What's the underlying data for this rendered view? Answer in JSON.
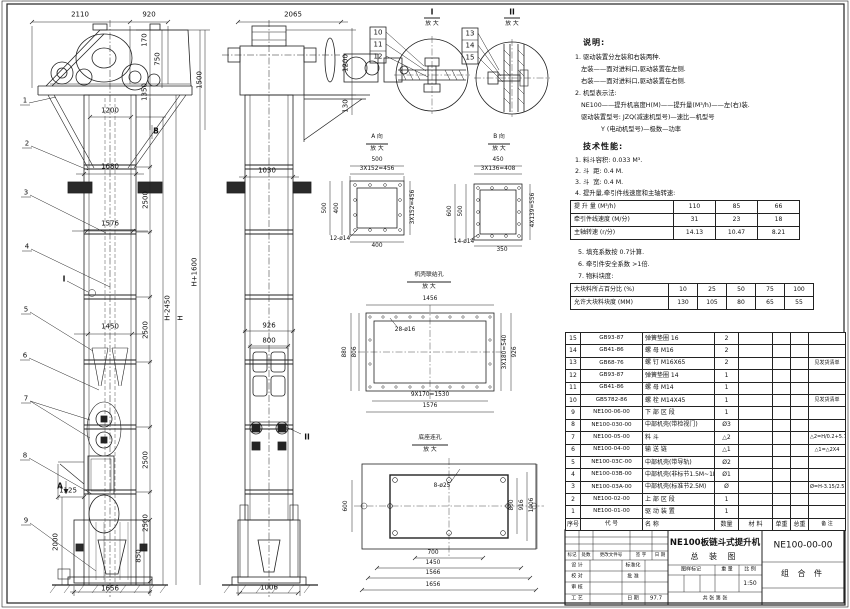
{
  "notes": {
    "heading": "说明:",
    "lines": [
      "1. 驱动装置分左装和右装两种.",
      "   左装——面对进料口,驱动装置在左侧.",
      "   右装——面对进料口,驱动装置在右侧.",
      "2. 机型表示法:",
      "   NE100——提升机高度H(M)——提升量(M³/h)——左(右)装.",
      "   驱动装置型号: JZQ(减速机型号)—速比—机型号",
      "             Y (电动机型号)—极数—功率"
    ]
  },
  "specs": {
    "heading": "技术性能:",
    "items": [
      "1. 料斗容积: 0.033 M³.",
      "2. 斗  距: 0.4 M.",
      "3. 斗  宽: 0.4 M.",
      "4. 提升量,牵引件线速度和主轴转速:"
    ],
    "table1": {
      "rows": [
        [
          "提 升 量 (M³/h)",
          "110",
          "85",
          "66"
        ],
        [
          "牵引件线速度 (M/分)",
          "31",
          "23",
          "18"
        ],
        [
          "主轴转速 (r/分)",
          "14.13",
          "10.47",
          "8.21"
        ]
      ]
    },
    "notes2": [
      "5. 填充系数按 0.7计算.",
      "6. 牵引件安全系数 >1倍.",
      "7. 物料块度:"
    ],
    "table2": {
      "rows": [
        [
          "大块料所占百分比 (%)",
          "10",
          "25",
          "50",
          "75",
          "100"
        ],
        [
          "允许大块料块度 (MM)",
          "130",
          "105",
          "80",
          "65",
          "55"
        ]
      ]
    }
  },
  "parts": {
    "rows": [
      [
        "15",
        "GB93-87",
        "弹簧垫圈 16",
        "2",
        "",
        "",
        "",
        ""
      ],
      [
        "14",
        "GB41-86",
        "螺 母 M16",
        "2",
        "",
        "",
        "",
        ""
      ],
      [
        "13",
        "GB68-76",
        "螺 钉 M16X65",
        "2",
        "",
        "",
        "",
        "见发货清单"
      ],
      [
        "12",
        "GB93-87",
        "弹簧垫圈 14",
        "1",
        "",
        "",
        "",
        ""
      ],
      [
        "11",
        "GB41-86",
        "螺 母 M14",
        "1",
        "",
        "",
        "",
        ""
      ],
      [
        "10",
        "GB5782-86",
        "螺 栓 M14X45",
        "1",
        "",
        "",
        "",
        "见发货清单"
      ],
      [
        "9",
        "NE100-06-00",
        "下 部 区 段",
        "1",
        "",
        "",
        "",
        ""
      ],
      [
        "8",
        "NE100-030-00",
        "中部机壳(带检视门)",
        "Ø3",
        "",
        "",
        "",
        ""
      ],
      [
        "7",
        "NE100-05-00",
        "料 斗",
        "△2",
        "",
        "",
        "",
        "△2=H/0.2+5.75"
      ],
      [
        "6",
        "NE100-04-00",
        "输 送 链",
        "△1",
        "",
        "",
        "",
        "△1=△2X4"
      ],
      [
        "5",
        "NE100-03C-00",
        "中部机壳(带导轨)",
        "Ø2",
        "",
        "",
        "",
        ""
      ],
      [
        "4",
        "NE100-03B-00",
        "中部机壳(非标节1.5M~1M)",
        "Ø1",
        "",
        "",
        "",
        ""
      ],
      [
        "3",
        "NE100-03A-00",
        "中部机壳(标准节2.5M)",
        "Ø",
        "",
        "",
        "",
        "Ø=H-3.15/2.5"
      ],
      [
        "2",
        "NE100-02-00",
        "上 部 区 段",
        "1",
        "",
        "",
        "",
        ""
      ],
      [
        "1",
        "NE100-01-00",
        "驱 动 装 置",
        "1",
        "",
        "",
        "",
        ""
      ],
      [
        "序号",
        "代  号",
        "名    称",
        "数量",
        "材  料",
        "单重",
        "总重",
        "备  注"
      ]
    ]
  },
  "titleblock": {
    "product": "NE100板链斗式提升机",
    "sheet_name": "总  装  图",
    "drawing_no": "NE100-00-00",
    "part_type": "组 合 件",
    "rev_header": [
      "标记",
      "处数",
      "更改文件号",
      "签 字",
      "日 期"
    ],
    "roles": [
      "设 计",
      "校 对",
      "审 核",
      "工 艺"
    ],
    "role_mids": [
      "标准化",
      "批 准",
      "",
      "日 期"
    ],
    "date": "97.7",
    "stamp_header": [
      "图样标记",
      "重 量",
      "比 例"
    ],
    "scale": "1:50",
    "sheets": "共  张  第  张"
  },
  "front": {
    "leaders": [
      "1",
      "2",
      "3",
      "4",
      "5",
      "6",
      "7",
      "8",
      "9"
    ],
    "marks": {
      "a": "A",
      "b": "B",
      "i": "I"
    },
    "dims": [
      "2110",
      "920",
      "170",
      "750",
      "1350",
      "1500",
      "1200",
      "1680",
      "2500",
      "1576",
      "H+1600",
      "H",
      "H-2450",
      "1450",
      "2500",
      "2500",
      "2500",
      "1125",
      "2000",
      "850",
      "1656"
    ]
  },
  "side": {
    "mark_ii": "II",
    "dims": [
      "2065",
      "1200",
      "130",
      "1030",
      "926",
      "800",
      "1006"
    ]
  },
  "detail_i": {
    "title": "I",
    "sub": "放 大",
    "leaders": [
      "10",
      "11",
      "12"
    ]
  },
  "detail_ii": {
    "title": "II",
    "sub": "放 大",
    "leaders": [
      "13",
      "14",
      "15"
    ]
  },
  "view_a": {
    "title": "A 向",
    "sub": "放 大",
    "dims": [
      "500",
      "3X152=456",
      "500",
      "400",
      "3X152=456",
      "400",
      "12-ø14"
    ]
  },
  "view_b": {
    "title": "B 向",
    "sub": "放 大",
    "dims": [
      "450",
      "3X136=408",
      "600",
      "500",
      "4X139=556",
      "350",
      "14-ø14"
    ]
  },
  "casing_view": {
    "title": "机壳联结孔",
    "sub": "放 大",
    "dims": [
      "1456",
      "28-ø16",
      "880",
      "806",
      "3X180=540",
      "926",
      "9X170=1530",
      "1576"
    ]
  },
  "base_view": {
    "title": "底座连孔",
    "sub": "放 大",
    "dims": [
      "8-ø25",
      "600",
      "800",
      "916",
      "1006",
      "700",
      "1450",
      "1566",
      "1656"
    ]
  }
}
